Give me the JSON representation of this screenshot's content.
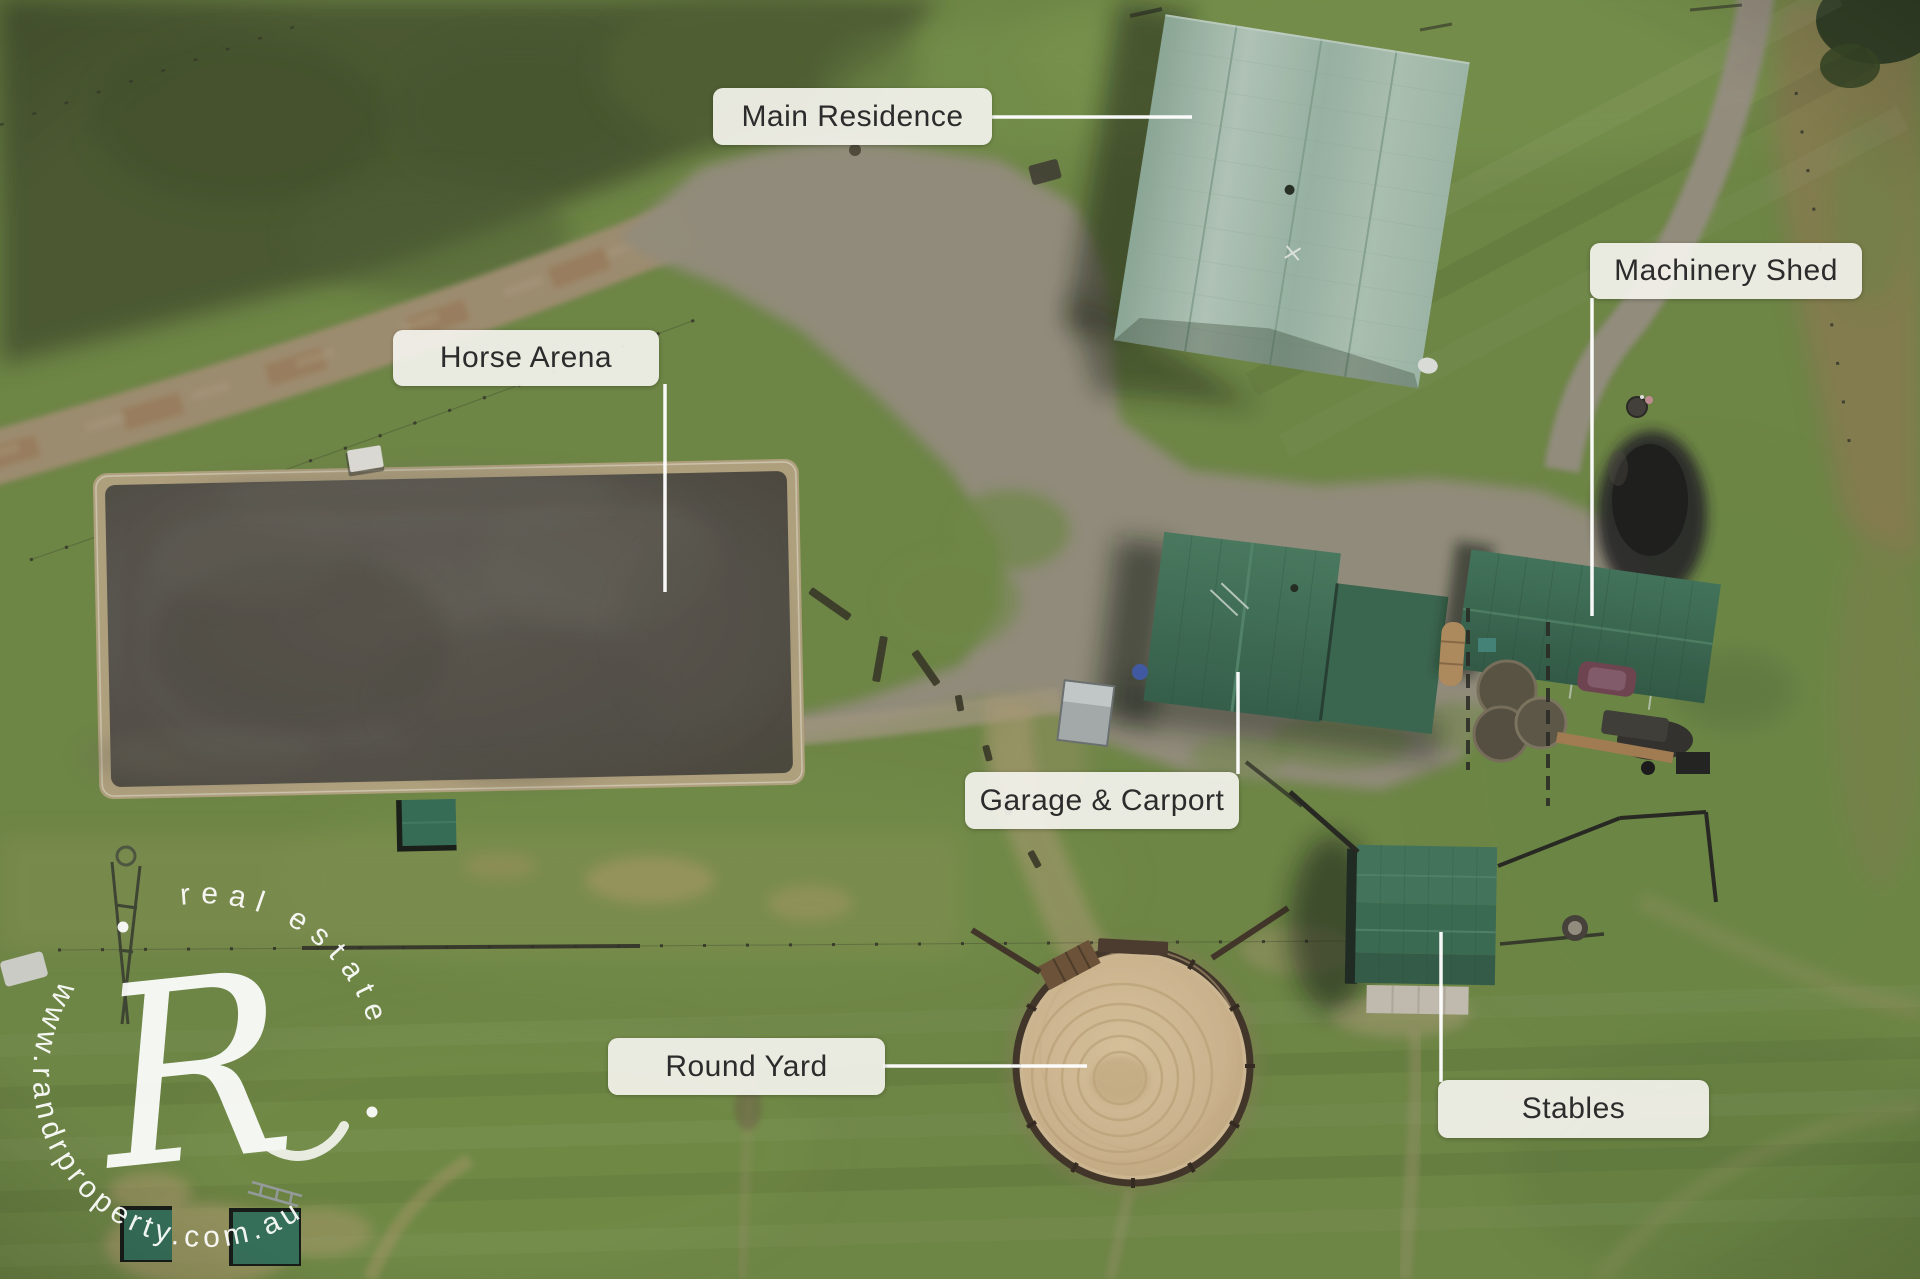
{
  "labels": [
    {
      "id": "main-residence",
      "text": "Main Residence"
    },
    {
      "id": "machinery-shed",
      "text": "Machinery Shed"
    },
    {
      "id": "horse-arena",
      "text": "Horse Arena"
    },
    {
      "id": "garage-carport",
      "text": "Garage & Carport"
    },
    {
      "id": "round-yard",
      "text": "Round Yard"
    },
    {
      "id": "stables",
      "text": "Stables"
    }
  ],
  "watermark": {
    "monogram": "R",
    "arc_top_text": "real estate",
    "arc_bottom_text": "www.randrproperty.com.au"
  },
  "colors": {
    "label_background": "#f2f1ea",
    "label_text": "#2c2c2c",
    "leader_line": "#ffffff",
    "watermark": "#ffffff",
    "grass": "#6d8840",
    "scrub_dark_green": "#46572b",
    "gravel": "#97907e",
    "dirt_road_tan": "#a3906f",
    "arena_surface": "#55514a",
    "arena_sand_border": "#b7a67f",
    "round_yard_sand": "#d9bf96",
    "round_yard_fence": "#3d2f21",
    "roof_pale_sage": "#aac6b3",
    "roof_dark_green": "#386e53"
  }
}
